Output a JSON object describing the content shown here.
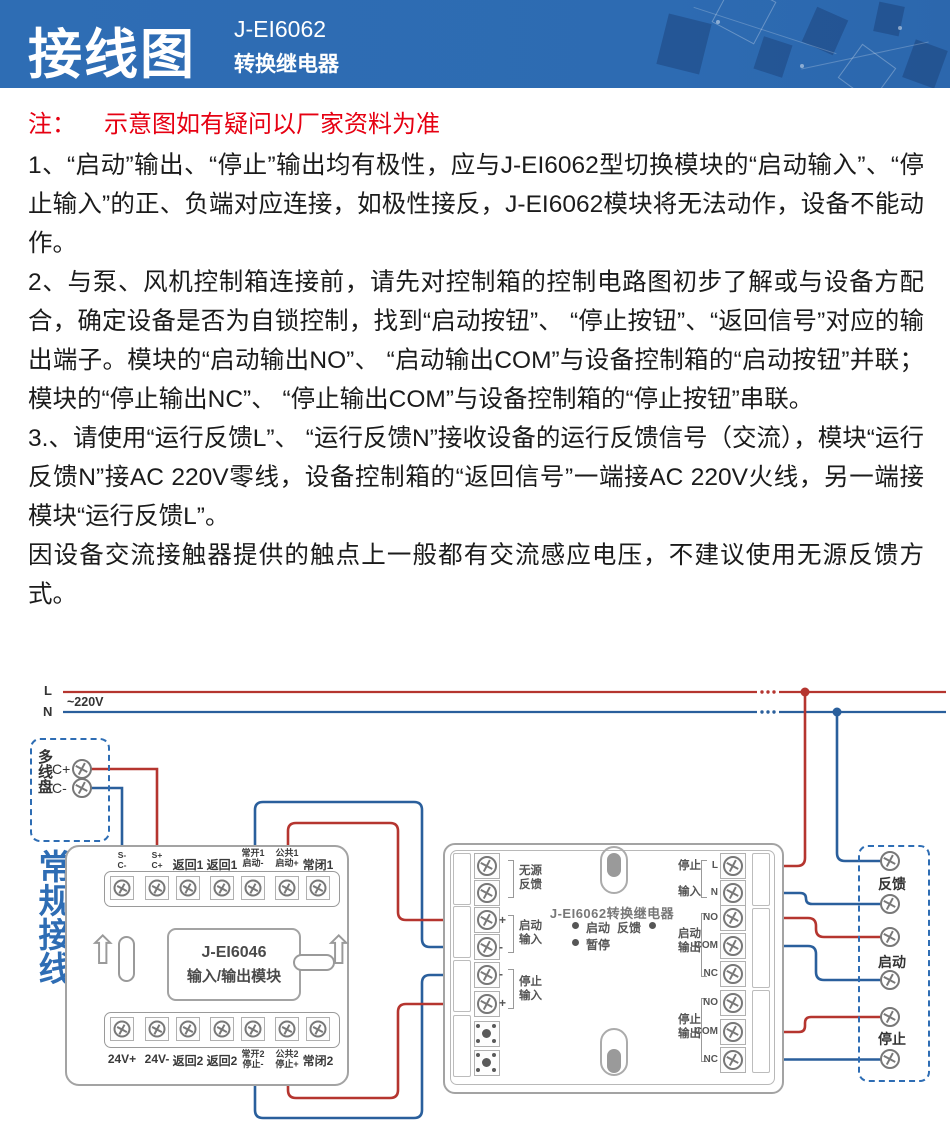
{
  "banner": {
    "title": "接线图",
    "model": "J-EI6062",
    "product": "转换继电器"
  },
  "note": {
    "label": "注：",
    "text": "示意图如有疑问以厂家资料为准"
  },
  "body": {
    "paragraphs": [
      "1、“启动”输出、“停止”输出均有极性，应与J-EI6062型切换模块的“启动输入”、“停止输入”的正、负端对应连接，如极性接反，J-EI6062模块将无法动作，设备不能动作。",
      "2、与泵、风机控制箱连接前，请先对控制箱的控制电路图初步了解或与设备方配合，确定设备是否为自锁控制，找到“启动按钮”、 “停止按钮”、“返回信号”对应的输出端子。模块的“启动输出NO”、 “启动输出COM”与设备控制箱的“启动按钮”并联；模块的“停止输出NC”、 “停止输出COM”与设备控制箱的“停止按钮”串联。",
      "3.、请使用“运行反馈L”、 “运行反馈N”接收设备的运行反馈信号（交流），模块“运行反馈N”接AC 220V零线，设备控制箱的“返回信号”一端接AC 220V火线，另一端接模块“运行反馈L”。",
      "因设备交流接触器提供的触点上一般都有交流感应电压，不建议使用无源反馈方式。"
    ]
  },
  "diagram": {
    "power": {
      "line1": "L",
      "line2": "N",
      "voltage": "~220V"
    },
    "loop_panel": {
      "title": "多线盘",
      "terminal_plus": "C+",
      "terminal_minus": "C-"
    },
    "side_note": "常规接线",
    "module_io": {
      "model": "J-EI6046",
      "name": "输入/输出模块",
      "top_terminals": [
        {
          "line1": "S-",
          "line2": "C-"
        },
        {
          "line1": "S+",
          "line2": "C+"
        },
        {
          "line1": "返回1",
          "line2": ""
        },
        {
          "line1": "返回1",
          "line2": ""
        },
        {
          "line1": "常开1",
          "line2": "启动-"
        },
        {
          "line1": "公共1",
          "line2": "启动+"
        },
        {
          "line1": "常闭1",
          "line2": ""
        }
      ],
      "bottom_terminals": [
        {
          "line1": "24V+",
          "line2": ""
        },
        {
          "line1": "24V-",
          "line2": ""
        },
        {
          "line1": "返回2",
          "line2": ""
        },
        {
          "line1": "返回2",
          "line2": ""
        },
        {
          "line1": "常开2",
          "line2": "停止-"
        },
        {
          "line1": "公共2",
          "line2": "停止+"
        },
        {
          "line1": "常闭2",
          "line2": ""
        }
      ]
    },
    "module_relay": {
      "title": "J-EI6062转换继电器",
      "led_start": "启动",
      "led_feedback": "反馈",
      "led_pause": "暂停",
      "group_passive": {
        "line1": "无源",
        "line2": "反馈"
      },
      "group_start_in": {
        "line1": "启动",
        "line2": "输入",
        "top_sign": "+",
        "bottom_sign": "-"
      },
      "group_stop_in": {
        "line1": "停止",
        "line2": "输入",
        "top_sign": "-",
        "bottom_sign": "+"
      },
      "group_ac_in": {
        "line1": "停止",
        "line2": "输入",
        "pin1": "L",
        "pin2": "N"
      },
      "group_start_out": {
        "line1": "启动",
        "line2": "输出",
        "pin1": "NO",
        "pin2": "COM",
        "pin3": "NC"
      },
      "group_stop_out": {
        "line1": "停止",
        "line2": "输出",
        "pin1": "NO",
        "pin2": "COM",
        "pin3": "NC"
      }
    },
    "device_panel": {
      "label_feedback": "反馈",
      "label_start": "启动",
      "label_stop": "停止"
    }
  },
  "colors": {
    "banner_blue": "#2e6db4",
    "note_red": "#e60012",
    "wire_red": "#b5352f",
    "wire_blue": "#2a5f9c",
    "accent_blue": "#2e6db4",
    "outline_gray": "#a3a3a3"
  }
}
